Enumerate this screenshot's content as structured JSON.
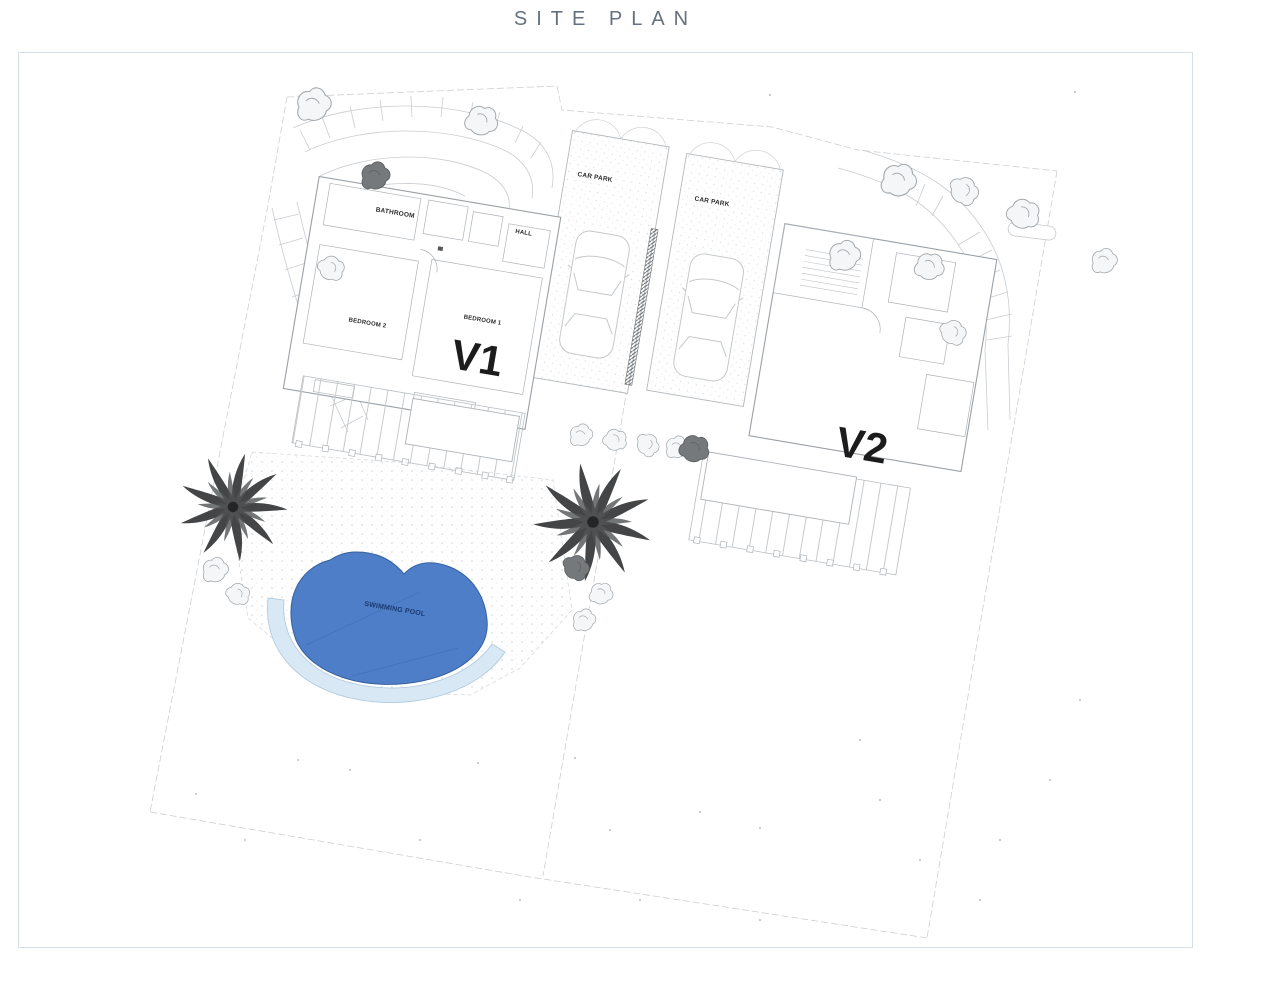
{
  "page": {
    "title": "SITE PLAN"
  },
  "plan": {
    "villa1": {
      "label": "V1",
      "rooms": {
        "bathroom": "BATHROOM",
        "hall": "HALL",
        "bedroom_left": "BEDROOM 2",
        "bedroom_right": "BEDROOM 1"
      }
    },
    "villa2": {
      "label": "V2"
    },
    "car_parks": [
      {
        "label": "CAR PARK"
      },
      {
        "label": "CAR PARK"
      }
    ],
    "pool": {
      "label": "SWIMMING POOL"
    }
  },
  "colors": {
    "pool_fill": "#4d7ec7",
    "pool_edge": "#35619f",
    "pool_deck": "#d8e8f5",
    "pool_deck_edge": "#aec8dd",
    "pool_text": "#1c3a6e",
    "title_text": "#66717f",
    "panel_border": "#d5dfe5"
  }
}
